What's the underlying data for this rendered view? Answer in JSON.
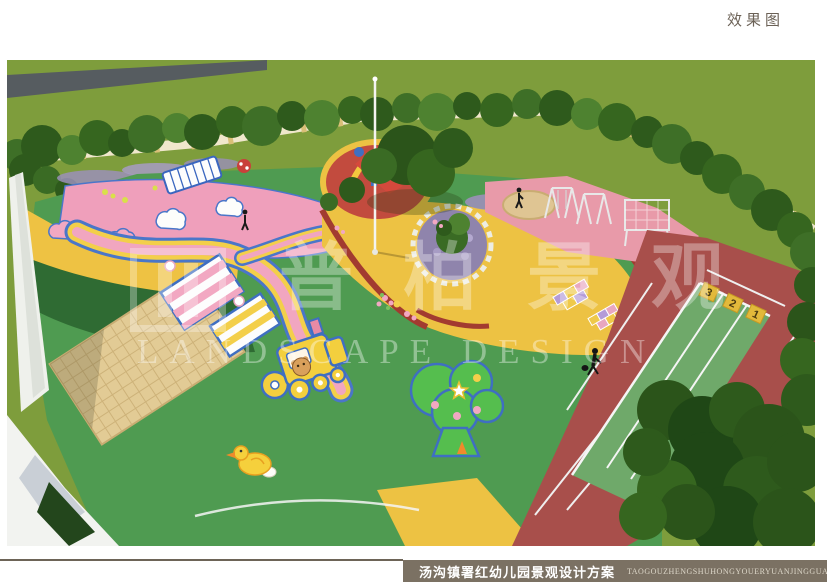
{
  "page": {
    "title": "效果图"
  },
  "watermark": {
    "cn_chars": [
      "普",
      "柏",
      "景",
      "观"
    ],
    "en": "LANDSCAPE DESIGN"
  },
  "rendering": {
    "track_lane_numbers": [
      "3",
      "2",
      "1"
    ]
  },
  "footer": {
    "caption_cn": "汤沟镇署红幼儿园景观设计方案",
    "caption_pinyin": "TAOGOUZHENGSHUHONGYOUERYUANJINGGUANSHEJIFANGAN"
  },
  "palette": {
    "outer_grass": "#7E9D3C",
    "play_green": "#4F9B51",
    "dark_green_zone": "#2F6B33",
    "pink_zone": "#EF9FBB",
    "yellow_zone": "#EDC243",
    "track_maroon": "#A84F4B",
    "sprint_lane_green": "#6FA96A",
    "lane_number_box": "#E2B93B",
    "sand": "#E2CB95",
    "edge_red": "#A23B30",
    "path_blue_outline": "#4A76C9",
    "caption_bar": "#7B7163",
    "title_text": "#6B6156"
  }
}
